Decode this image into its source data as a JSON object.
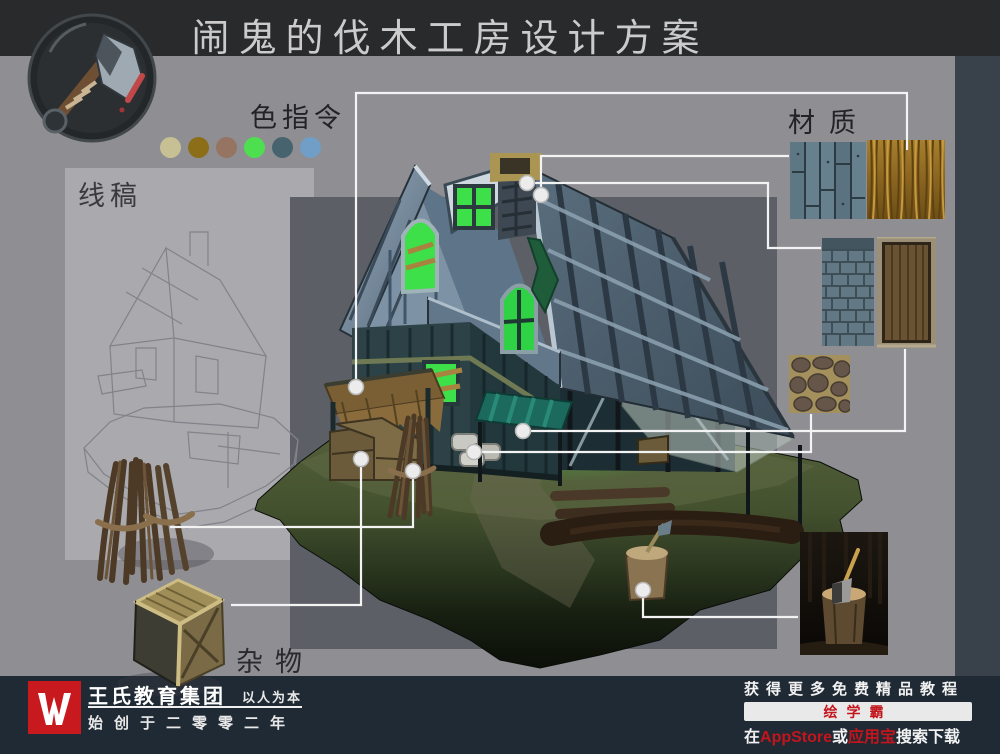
{
  "title": "闹鬼的伐木工房设计方案",
  "sections": {
    "palette": {
      "label": "色指令",
      "colors": [
        "#c6c094",
        "#8c6e19",
        "#957461",
        "#4ddf4f",
        "#47646e",
        "#709ec6"
      ]
    },
    "sketch": {
      "label": "线稿"
    },
    "materials": {
      "label": "材质",
      "items": [
        "wood-planks",
        "thatch",
        "roof-shingles",
        "wooden-door",
        "cobblestone",
        "axe-in-stump-photo"
      ]
    },
    "props": {
      "label": "杂物"
    }
  },
  "callouts": [
    "thatch-awning to thatch-texture",
    "roof-shingles to shingle-texture",
    "chimney to plank-texture",
    "green-awning to door-texture",
    "stone-blocks to cobblestone-texture",
    "porch-crates to crate-prop",
    "stick-bundle to sticks-prop",
    "tree-stump to axe-photo"
  ],
  "footer": {
    "brand": "王氏教育集团",
    "motto": "以人为本",
    "founded": "始创于二零零二年",
    "promo_line": "获得更多免费精品教程",
    "app_name": "绘学霸",
    "download_prefix": "在",
    "store1": "AppStore",
    "download_or": "或",
    "store2": "应用宝",
    "download_suffix": "搜索下载"
  },
  "colors": {
    "accent_red": "#c2151c",
    "callout_line": "#f3f3f3",
    "window_glow_green": "#3ee04a",
    "panel_dark": "#5c6066",
    "panel_light": "#a9a9ae"
  }
}
